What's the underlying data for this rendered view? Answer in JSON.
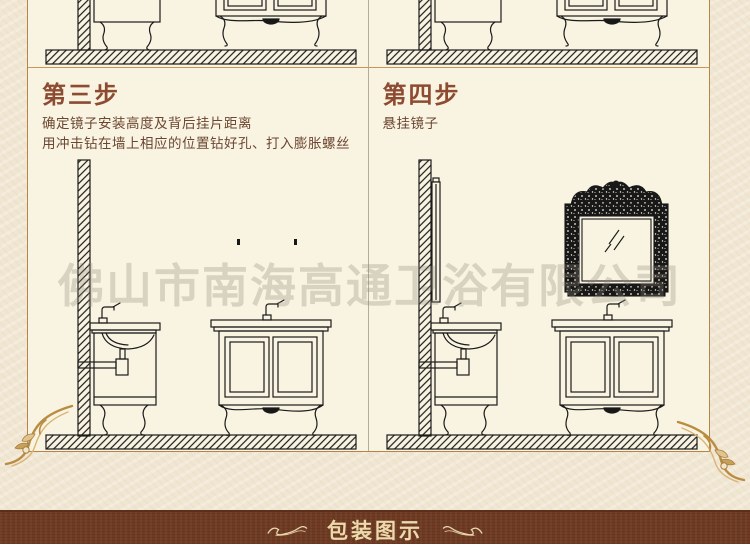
{
  "watermark": {
    "text": "佛山市南海高通卫浴有限公司"
  },
  "steps": [
    {
      "id": "step-3",
      "title": "第三步",
      "desc_lines": [
        "确定镜子安装高度及背后挂片距离",
        "用冲击钻在墙上相应的位置钻好孔、打入膨胀螺丝"
      ]
    },
    {
      "id": "step-4",
      "title": "第四步",
      "desc_lines": [
        "悬挂镜子"
      ]
    }
  ],
  "footer": {
    "banner_label": "包装图示"
  },
  "colors": {
    "heading_text": "#8d4c32",
    "body_text": "#6b4632",
    "panel_bg": "#f9f4e1",
    "outer_bg": "#f0e6d2",
    "frame_border": "#b3854d",
    "banner_bg": "#6e3a22",
    "banner_text": "#ecd9ac",
    "ornament_gold": "#c49a52",
    "line_art": "#1a1a1a"
  }
}
